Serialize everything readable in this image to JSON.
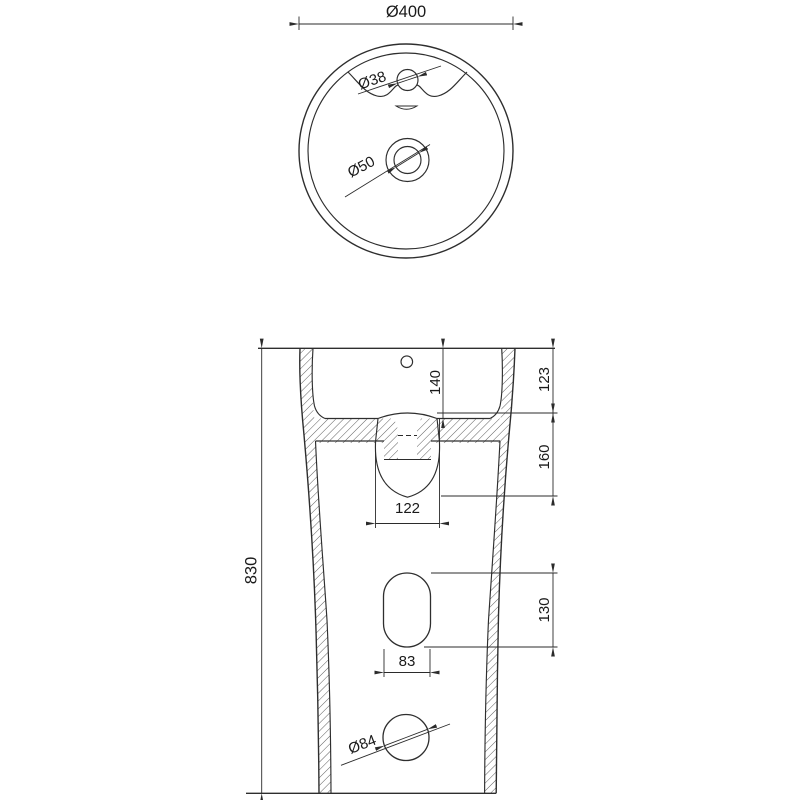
{
  "drawing": {
    "background": "#ffffff",
    "line_color": "#2e2e2e",
    "views": {
      "top": {
        "name": "basin top view",
        "outer_diameter": "Ø400",
        "faucet_hole_diameter": "Ø38",
        "drain_hole_diameter": "Ø50"
      },
      "front": {
        "name": "pedestal front section view",
        "total_height": "830",
        "basin_inner_depth": "140",
        "rim_to_mount_plane": "123",
        "trap_zone_height": "160",
        "trap_width": "122",
        "service_opening_height": "130",
        "service_opening_width": "83",
        "outlet_hole_diameter": "Ø84"
      }
    }
  }
}
